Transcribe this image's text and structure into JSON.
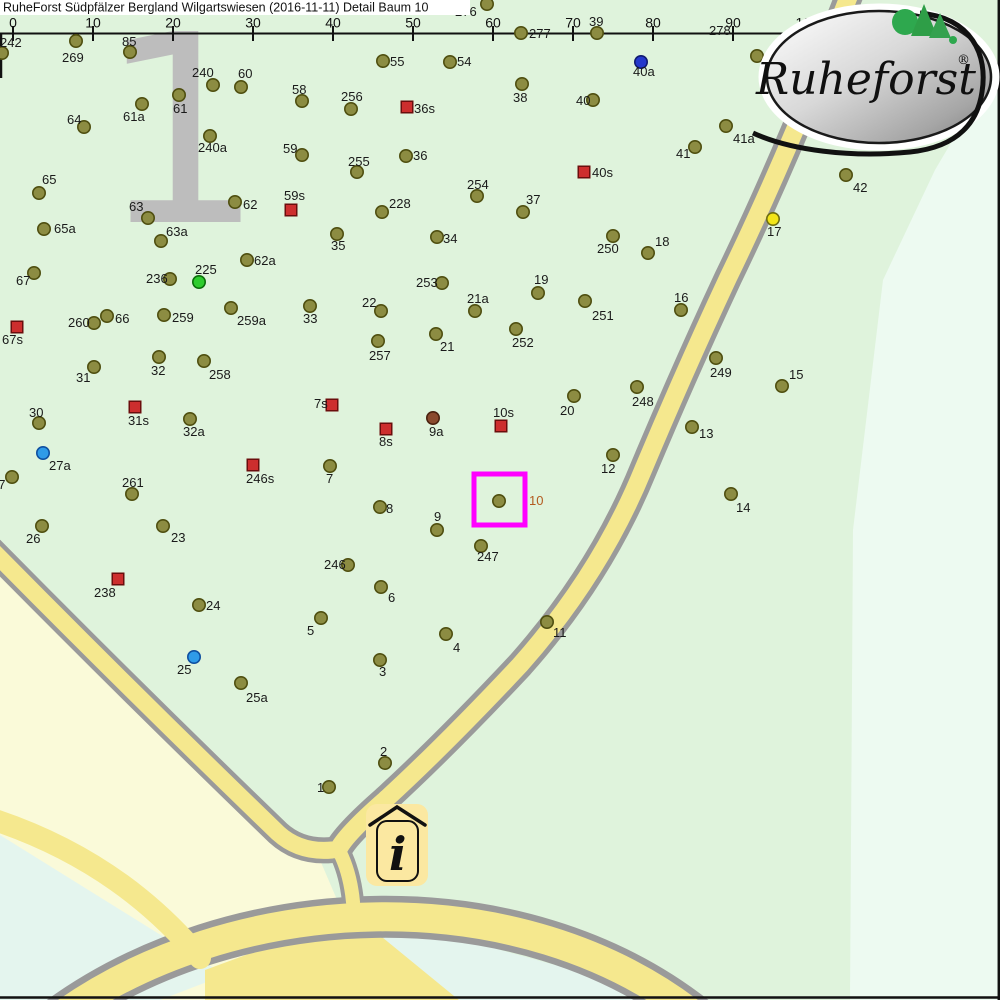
{
  "header": {
    "title": "RuheForst Südpfälzer Bergland Wilgartswiesen (2016-11-11) Detail  Baum 10"
  },
  "ruler": {
    "x0": 13,
    "spacing": 80,
    "y": 33,
    "ticks": [
      "0",
      "10",
      "20",
      "30",
      "40",
      "50",
      "60",
      "70",
      "80",
      "90",
      "100m"
    ]
  },
  "logo": {
    "brand": "Ruheforst",
    "registered": "®"
  },
  "watermark": {
    "digit": "1"
  },
  "info_marker": {
    "symbol": "i"
  },
  "selection": {
    "tree_id": "10",
    "x": 474,
    "y": 474,
    "size": 51
  },
  "colors": {
    "forest_green": "#dff3dc",
    "forest_green_light": "#edfaf1",
    "meadow_yellow": "#fafad9",
    "water_cyan": "#e4f5ee",
    "road_fill": "#f5e88e",
    "road_border": "#9a9a9a",
    "selection_magenta": "#ff00ff",
    "selected_label": "#b35a1f",
    "label_black": "#1a1a1a"
  },
  "marker_styles": {
    "tree": {
      "fill": "#8c8c42",
      "stroke": "#4f4f10"
    },
    "marked": {
      "fill": "#cd2e2e",
      "stroke": "#6b0d0d"
    },
    "blue": {
      "fill": "#2f9be8",
      "stroke": "#0f4fa0"
    },
    "deepblue": {
      "fill": "#2438cc",
      "stroke": "#101a70"
    },
    "green": {
      "fill": "#2ecc2e",
      "stroke": "#0a6e0a"
    },
    "yellow": {
      "fill": "#f2e518",
      "stroke": "#6e6e10"
    },
    "brown": {
      "fill": "#8a4a2e",
      "stroke": "#4a2210"
    }
  },
  "trees": [
    [
      "242",
      "tree",
      2,
      53,
      0,
      47
    ],
    [
      "269",
      "tree",
      76,
      41,
      62,
      62
    ],
    [
      "85",
      "tree",
      130,
      52,
      122,
      46
    ],
    [
      "276",
      "tree",
      487,
      4,
      455,
      16
    ],
    [
      "277",
      "tree",
      521,
      33,
      529,
      38
    ],
    [
      "39",
      "tree",
      597,
      33,
      589,
      26
    ],
    [
      "278",
      "label",
      733,
      30,
      709,
      35
    ],
    [
      "43",
      "tree",
      757,
      56,
      767,
      63
    ],
    [
      "40a",
      "deepblue",
      641,
      62,
      633,
      76
    ],
    [
      "55",
      "tree",
      383,
      61,
      390,
      66
    ],
    [
      "54",
      "tree",
      450,
      62,
      457,
      66
    ],
    [
      "38",
      "tree",
      522,
      84,
      513,
      102
    ],
    [
      "40",
      "tree",
      593,
      100,
      576,
      105
    ],
    [
      "256",
      "tree",
      351,
      109,
      341,
      101
    ],
    [
      "36s",
      "marked",
      407,
      107,
      414,
      113
    ],
    [
      "36",
      "tree",
      406,
      156,
      413,
      160
    ],
    [
      "255",
      "tree",
      357,
      172,
      348,
      166
    ],
    [
      "40s",
      "marked",
      584,
      172,
      592,
      177
    ],
    [
      "254",
      "tree",
      477,
      196,
      467,
      189
    ],
    [
      "37",
      "tree",
      523,
      212,
      526,
      204
    ],
    [
      "228",
      "tree",
      382,
      212,
      389,
      208
    ],
    [
      "35",
      "tree",
      337,
      234,
      331,
      250
    ],
    [
      "34",
      "tree",
      437,
      237,
      443,
      243
    ],
    [
      "250",
      "tree",
      613,
      236,
      597,
      253
    ],
    [
      "18",
      "tree",
      648,
      253,
      655,
      246
    ],
    [
      "42",
      "tree",
      846,
      175,
      853,
      192
    ],
    [
      "41a",
      "tree",
      726,
      126,
      733,
      143
    ],
    [
      "41",
      "tree",
      695,
      147,
      676,
      158
    ],
    [
      "17",
      "yellow",
      773,
      219,
      767,
      236
    ],
    [
      "62",
      "tree",
      235,
      202,
      243,
      209
    ],
    [
      "59s",
      "marked",
      291,
      210,
      284,
      200
    ],
    [
      "59",
      "tree",
      302,
      155,
      283,
      153
    ],
    [
      "58",
      "tree",
      302,
      101,
      292,
      94
    ],
    [
      "60",
      "tree",
      241,
      87,
      238,
      78
    ],
    [
      "240",
      "tree",
      213,
      85,
      192,
      77
    ],
    [
      "61",
      "tree",
      179,
      95,
      173,
      113
    ],
    [
      "61a",
      "tree",
      142,
      104,
      123,
      121
    ],
    [
      "64",
      "tree",
      84,
      127,
      67,
      124
    ],
    [
      "240a",
      "tree",
      210,
      136,
      198,
      152
    ],
    [
      "65",
      "tree",
      39,
      193,
      42,
      184
    ],
    [
      "63",
      "tree",
      148,
      218,
      129,
      211
    ],
    [
      "63a",
      "tree",
      161,
      241,
      166,
      236
    ],
    [
      "65a",
      "tree",
      44,
      229,
      54,
      233
    ],
    [
      "67",
      "tree",
      34,
      273,
      16,
      285
    ],
    [
      "236",
      "tree",
      170,
      279,
      146,
      283
    ],
    [
      "225",
      "green",
      199,
      282,
      195,
      274
    ],
    [
      "62a",
      "tree",
      247,
      260,
      254,
      265
    ],
    [
      "66",
      "tree",
      107,
      316,
      115,
      323
    ],
    [
      "260",
      "tree",
      94,
      323,
      68,
      327
    ],
    [
      "259",
      "tree",
      164,
      315,
      172,
      322
    ],
    [
      "259a",
      "tree",
      231,
      308,
      237,
      325
    ],
    [
      "33",
      "tree",
      310,
      306,
      303,
      323
    ],
    [
      "67s",
      "marked",
      17,
      327,
      2,
      344
    ],
    [
      "31",
      "tree",
      94,
      367,
      76,
      382
    ],
    [
      "32",
      "tree",
      159,
      357,
      151,
      375
    ],
    [
      "258",
      "tree",
      204,
      361,
      209,
      379
    ],
    [
      "30",
      "tree",
      39,
      423,
      29,
      417
    ],
    [
      "31s",
      "marked",
      135,
      407,
      128,
      425
    ],
    [
      "32a",
      "tree",
      190,
      419,
      183,
      436
    ],
    [
      "7s",
      "marked",
      332,
      405,
      314,
      408
    ],
    [
      "27a",
      "blue",
      43,
      453,
      49,
      470
    ],
    [
      "246s",
      "marked",
      253,
      465,
      246,
      483
    ],
    [
      "7",
      "tree",
      330,
      466,
      326,
      483
    ],
    [
      "261",
      "tree",
      132,
      494,
      122,
      487
    ],
    [
      "26",
      "tree",
      42,
      526,
      26,
      543
    ],
    [
      "23",
      "tree",
      163,
      526,
      171,
      542
    ],
    [
      "238",
      "marked",
      118,
      579,
      94,
      597
    ],
    [
      "24",
      "tree",
      199,
      605,
      206,
      610
    ],
    [
      "5",
      "tree",
      321,
      618,
      307,
      635
    ],
    [
      "25",
      "blue",
      194,
      657,
      177,
      674
    ],
    [
      "25a",
      "tree",
      241,
      683,
      246,
      702
    ],
    [
      "27",
      "tree",
      12,
      477,
      -9,
      489
    ],
    [
      "253",
      "tree",
      442,
      283,
      416,
      287
    ],
    [
      "19",
      "tree",
      538,
      293,
      534,
      284
    ],
    [
      "22",
      "tree",
      381,
      311,
      362,
      307
    ],
    [
      "21a",
      "tree",
      475,
      311,
      467,
      303
    ],
    [
      "251",
      "tree",
      585,
      301,
      592,
      320
    ],
    [
      "252",
      "tree",
      516,
      329,
      512,
      347
    ],
    [
      "21",
      "tree",
      436,
      334,
      440,
      351
    ],
    [
      "257",
      "tree",
      378,
      341,
      369,
      360
    ],
    [
      "248",
      "tree",
      637,
      387,
      632,
      406
    ],
    [
      "20",
      "tree",
      574,
      396,
      560,
      415
    ],
    [
      "16",
      "tree",
      681,
      310,
      674,
      302
    ],
    [
      "249",
      "tree",
      716,
      358,
      710,
      377
    ],
    [
      "15",
      "tree",
      782,
      386,
      789,
      379
    ],
    [
      "13",
      "tree",
      692,
      427,
      699,
      438
    ],
    [
      "14",
      "tree",
      731,
      494,
      736,
      512
    ],
    [
      "10s",
      "marked",
      501,
      426,
      493,
      417
    ],
    [
      "9a",
      "brown",
      433,
      418,
      429,
      436
    ],
    [
      "8s",
      "marked",
      386,
      429,
      379,
      446
    ],
    [
      "12",
      "tree",
      613,
      455,
      601,
      473
    ],
    [
      "10",
      "selected",
      499,
      501,
      529,
      505
    ],
    [
      "8",
      "tree",
      380,
      507,
      386,
      513
    ],
    [
      "9",
      "tree",
      437,
      530,
      434,
      521
    ],
    [
      "247",
      "tree",
      481,
      546,
      477,
      561
    ],
    [
      "246",
      "tree",
      348,
      565,
      324,
      569
    ],
    [
      "6",
      "tree",
      381,
      587,
      388,
      602
    ],
    [
      "4",
      "tree",
      446,
      634,
      453,
      652
    ],
    [
      "11",
      "tree",
      547,
      622,
      553,
      637
    ],
    [
      "3",
      "tree",
      380,
      660,
      379,
      676
    ],
    [
      "2",
      "tree",
      385,
      763,
      380,
      756
    ],
    [
      "1",
      "tree",
      329,
      787,
      317,
      792
    ]
  ]
}
